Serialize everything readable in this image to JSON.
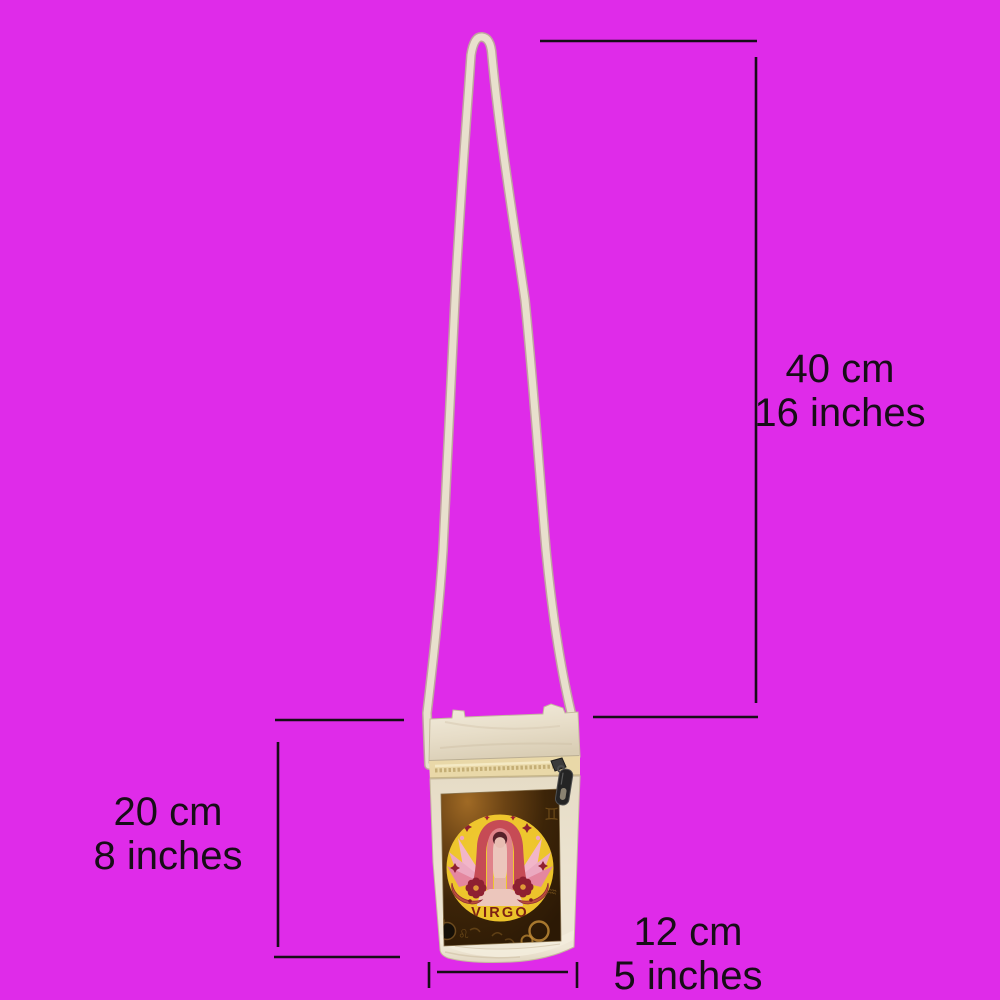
{
  "scene": {
    "background_color": "#df2be9",
    "annotation_color": "#170d17"
  },
  "bag": {
    "label": "VIRGO",
    "panel_glyphs": [
      "♊",
      "♌",
      "♒"
    ],
    "colors": {
      "canvas": "#ece3d0",
      "strap": "#e8e0cd",
      "zipper_tape": "#e9d8a8",
      "zipper_pull": "#242424",
      "panel_background": "#3c2408",
      "zodiac_circle": "#ecc32a",
      "hair": "#c64b55",
      "skin": "#ecc6bc",
      "wings": "#eba9c0",
      "flower": "#8e2031",
      "label_text": "#7d2113"
    }
  },
  "measurements": {
    "strap_drop": {
      "cm": "40 cm",
      "inches": "16 inches"
    },
    "height": {
      "cm": "20 cm",
      "inches": "8 inches"
    },
    "width": {
      "cm": "12 cm",
      "inches": "5 inches"
    }
  }
}
